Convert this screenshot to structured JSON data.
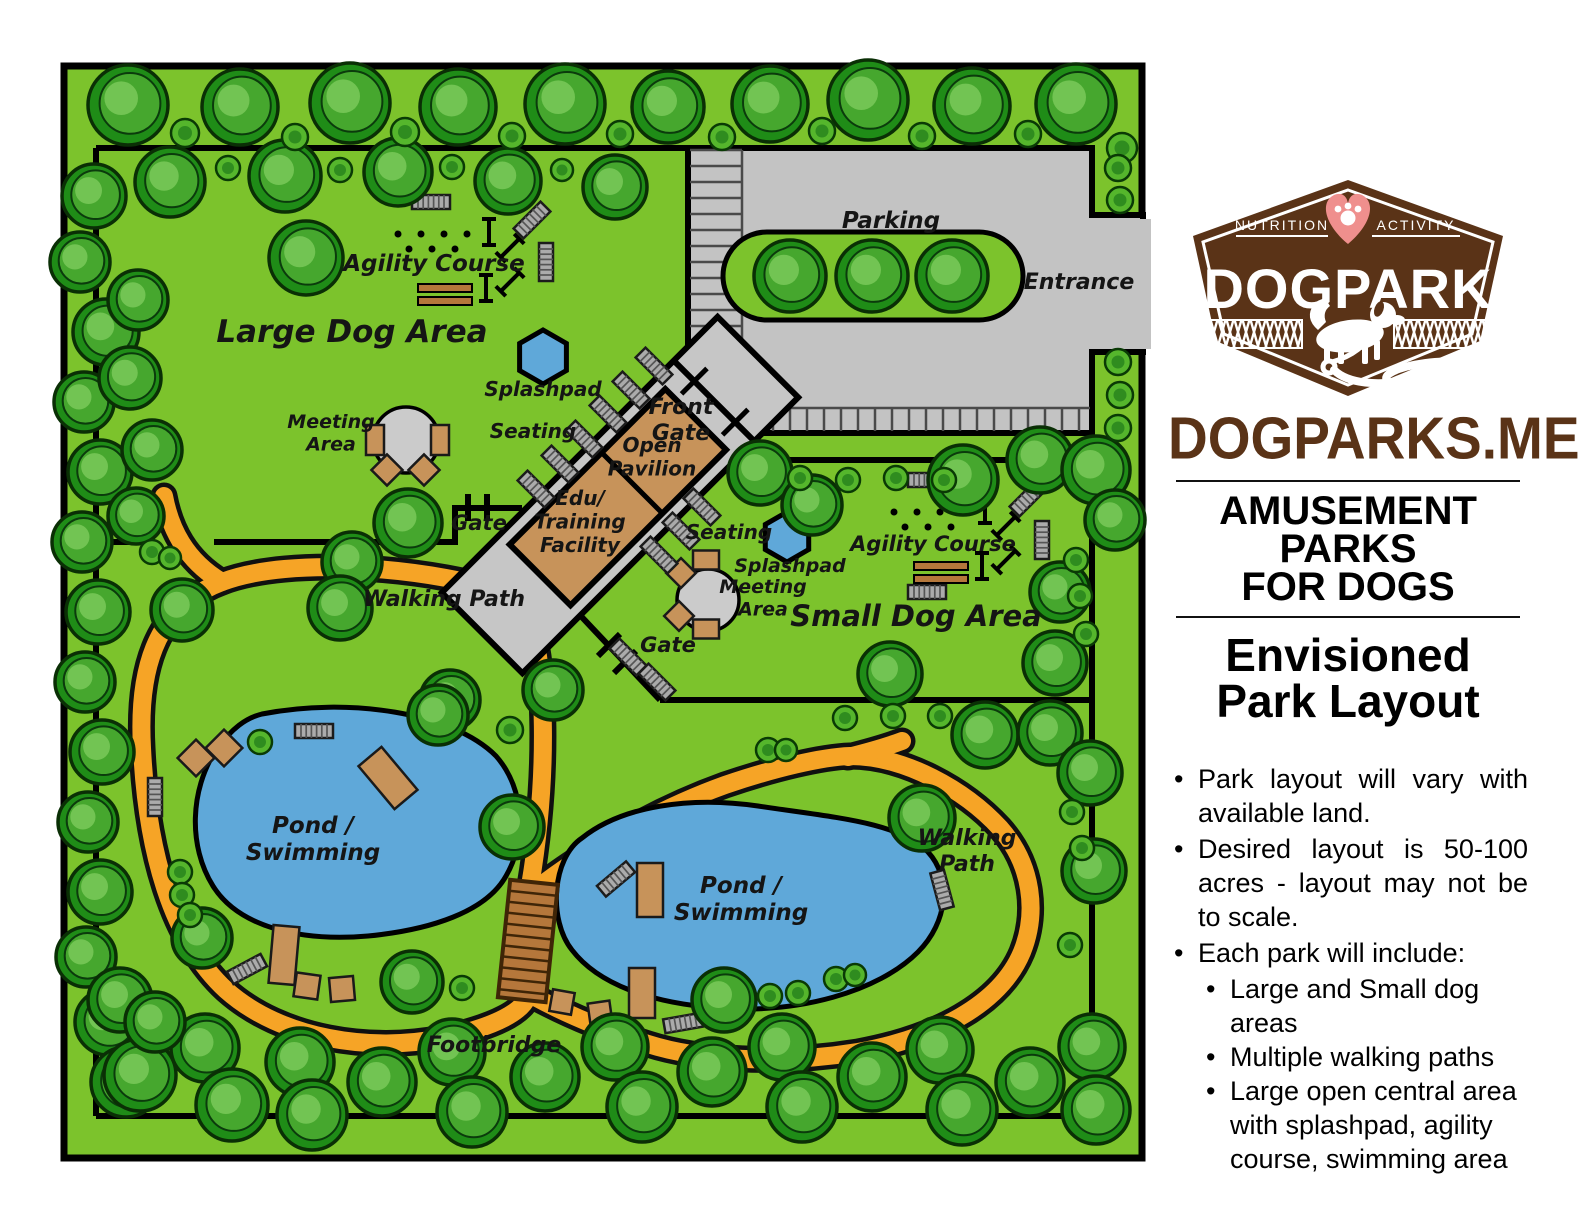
{
  "title": "Envisioned Dog Park Layout",
  "sidebar": {
    "logo": {
      "nutrition": "NUTRITION",
      "activity": "ACTIVITY",
      "brand": "DOGPARK"
    },
    "site": "DOGPARKS.ME",
    "heading1_lines": [
      "AMUSEMENT",
      "PARKS",
      "FOR DOGS"
    ],
    "heading2_lines": [
      "Envisioned",
      "Park Layout"
    ],
    "bullets": [
      {
        "level": 1,
        "text": "Park layout will vary with available land."
      },
      {
        "level": 1,
        "text": "Desired layout is 50-100 acres - layout may not be to scale."
      },
      {
        "level": 1,
        "text": "Each park will include:"
      },
      {
        "level": 2,
        "text": "Large and Small dog areas"
      },
      {
        "level": 2,
        "text": "Multiple walking paths"
      },
      {
        "level": 2,
        "text": "Large open central area with splashpad, agility course, swimming area"
      }
    ]
  },
  "map": {
    "colors": {
      "grass": "#7cc32c",
      "tree_ring": "#1f8c17",
      "tree_mid": "#46a72e",
      "tree_light": "#72c453",
      "bush": "#55b62c",
      "bush_core": "#2f8c1f",
      "path": "#f6a426",
      "water": "#5fa8d9",
      "parking": "#c3c3c3",
      "corridor": "#c6c6c6",
      "building": "#c7935a",
      "bench_tan": "#c7935a",
      "bench_gray": "#ababab",
      "bridge": "#b5773b",
      "outline": "#000000",
      "brand_brown": "#5a3317",
      "heart_pink": "#ef8f8d"
    },
    "labels": [
      {
        "id": "agility-course-large",
        "lines": [
          "Agility Course"
        ],
        "x": 434,
        "y": 271,
        "size": 23
      },
      {
        "id": "large-dog-area",
        "lines": [
          "Large Dog Area"
        ],
        "x": 352,
        "y": 342,
        "size": 31
      },
      {
        "id": "splashpad-large",
        "lines": [
          "Splashpad"
        ],
        "x": 543,
        "y": 396,
        "size": 20
      },
      {
        "id": "meeting-area-large",
        "lines": [
          "Meeting",
          "Area"
        ],
        "x": 331,
        "y": 428,
        "size": 19
      },
      {
        "id": "seating-large",
        "lines": [
          "Seating"
        ],
        "x": 533,
        "y": 438,
        "size": 20
      },
      {
        "id": "front-gate",
        "lines": [
          "Front",
          "Gate"
        ],
        "x": 681,
        "y": 414,
        "size": 22
      },
      {
        "id": "open-pavilion",
        "lines": [
          "Open",
          "Pavilion"
        ],
        "x": 652,
        "y": 452,
        "size": 20
      },
      {
        "id": "edu-training-facility",
        "lines": [
          "Edu/",
          "Training",
          "Facility"
        ],
        "x": 580,
        "y": 505,
        "size": 20
      },
      {
        "id": "gate-large-dog",
        "lines": [
          "Gate"
        ],
        "x": 479,
        "y": 530,
        "size": 21
      },
      {
        "id": "seating-small",
        "lines": [
          "Seating"
        ],
        "x": 729,
        "y": 539,
        "size": 20
      },
      {
        "id": "splashpad-small",
        "lines": [
          "Splashpad"
        ],
        "x": 790,
        "y": 572,
        "size": 19
      },
      {
        "id": "meeting-area-small",
        "lines": [
          "Meeting",
          "Area"
        ],
        "x": 763,
        "y": 593,
        "size": 19
      },
      {
        "id": "agility-course-small",
        "lines": [
          "Agility Course"
        ],
        "x": 933,
        "y": 551,
        "size": 21
      },
      {
        "id": "small-dog-area",
        "lines": [
          "Small Dog Area"
        ],
        "x": 916,
        "y": 626,
        "size": 29
      },
      {
        "id": "gate-small-dog",
        "lines": [
          "Gate"
        ],
        "x": 668,
        "y": 652,
        "size": 21
      },
      {
        "id": "walking-path-left",
        "lines": [
          "Walking Path"
        ],
        "x": 444,
        "y": 606,
        "size": 22
      },
      {
        "id": "parking",
        "lines": [
          "Parking"
        ],
        "x": 891,
        "y": 228,
        "size": 23
      },
      {
        "id": "entrance",
        "lines": [
          "Entrance"
        ],
        "x": 1079,
        "y": 289,
        "size": 22
      },
      {
        "id": "pond-swimming-left",
        "lines": [
          "Pond /",
          "Swimming"
        ],
        "x": 313,
        "y": 833,
        "size": 23
      },
      {
        "id": "pond-swimming-right",
        "lines": [
          "Pond /",
          "Swimming"
        ],
        "x": 741,
        "y": 893,
        "size": 23
      },
      {
        "id": "walking-path-right",
        "lines": [
          "Walking",
          "Path"
        ],
        "x": 967,
        "y": 845,
        "size": 22
      },
      {
        "id": "footbridge",
        "lines": [
          "Footbridge"
        ],
        "x": 494,
        "y": 1052,
        "size": 22
      }
    ]
  }
}
